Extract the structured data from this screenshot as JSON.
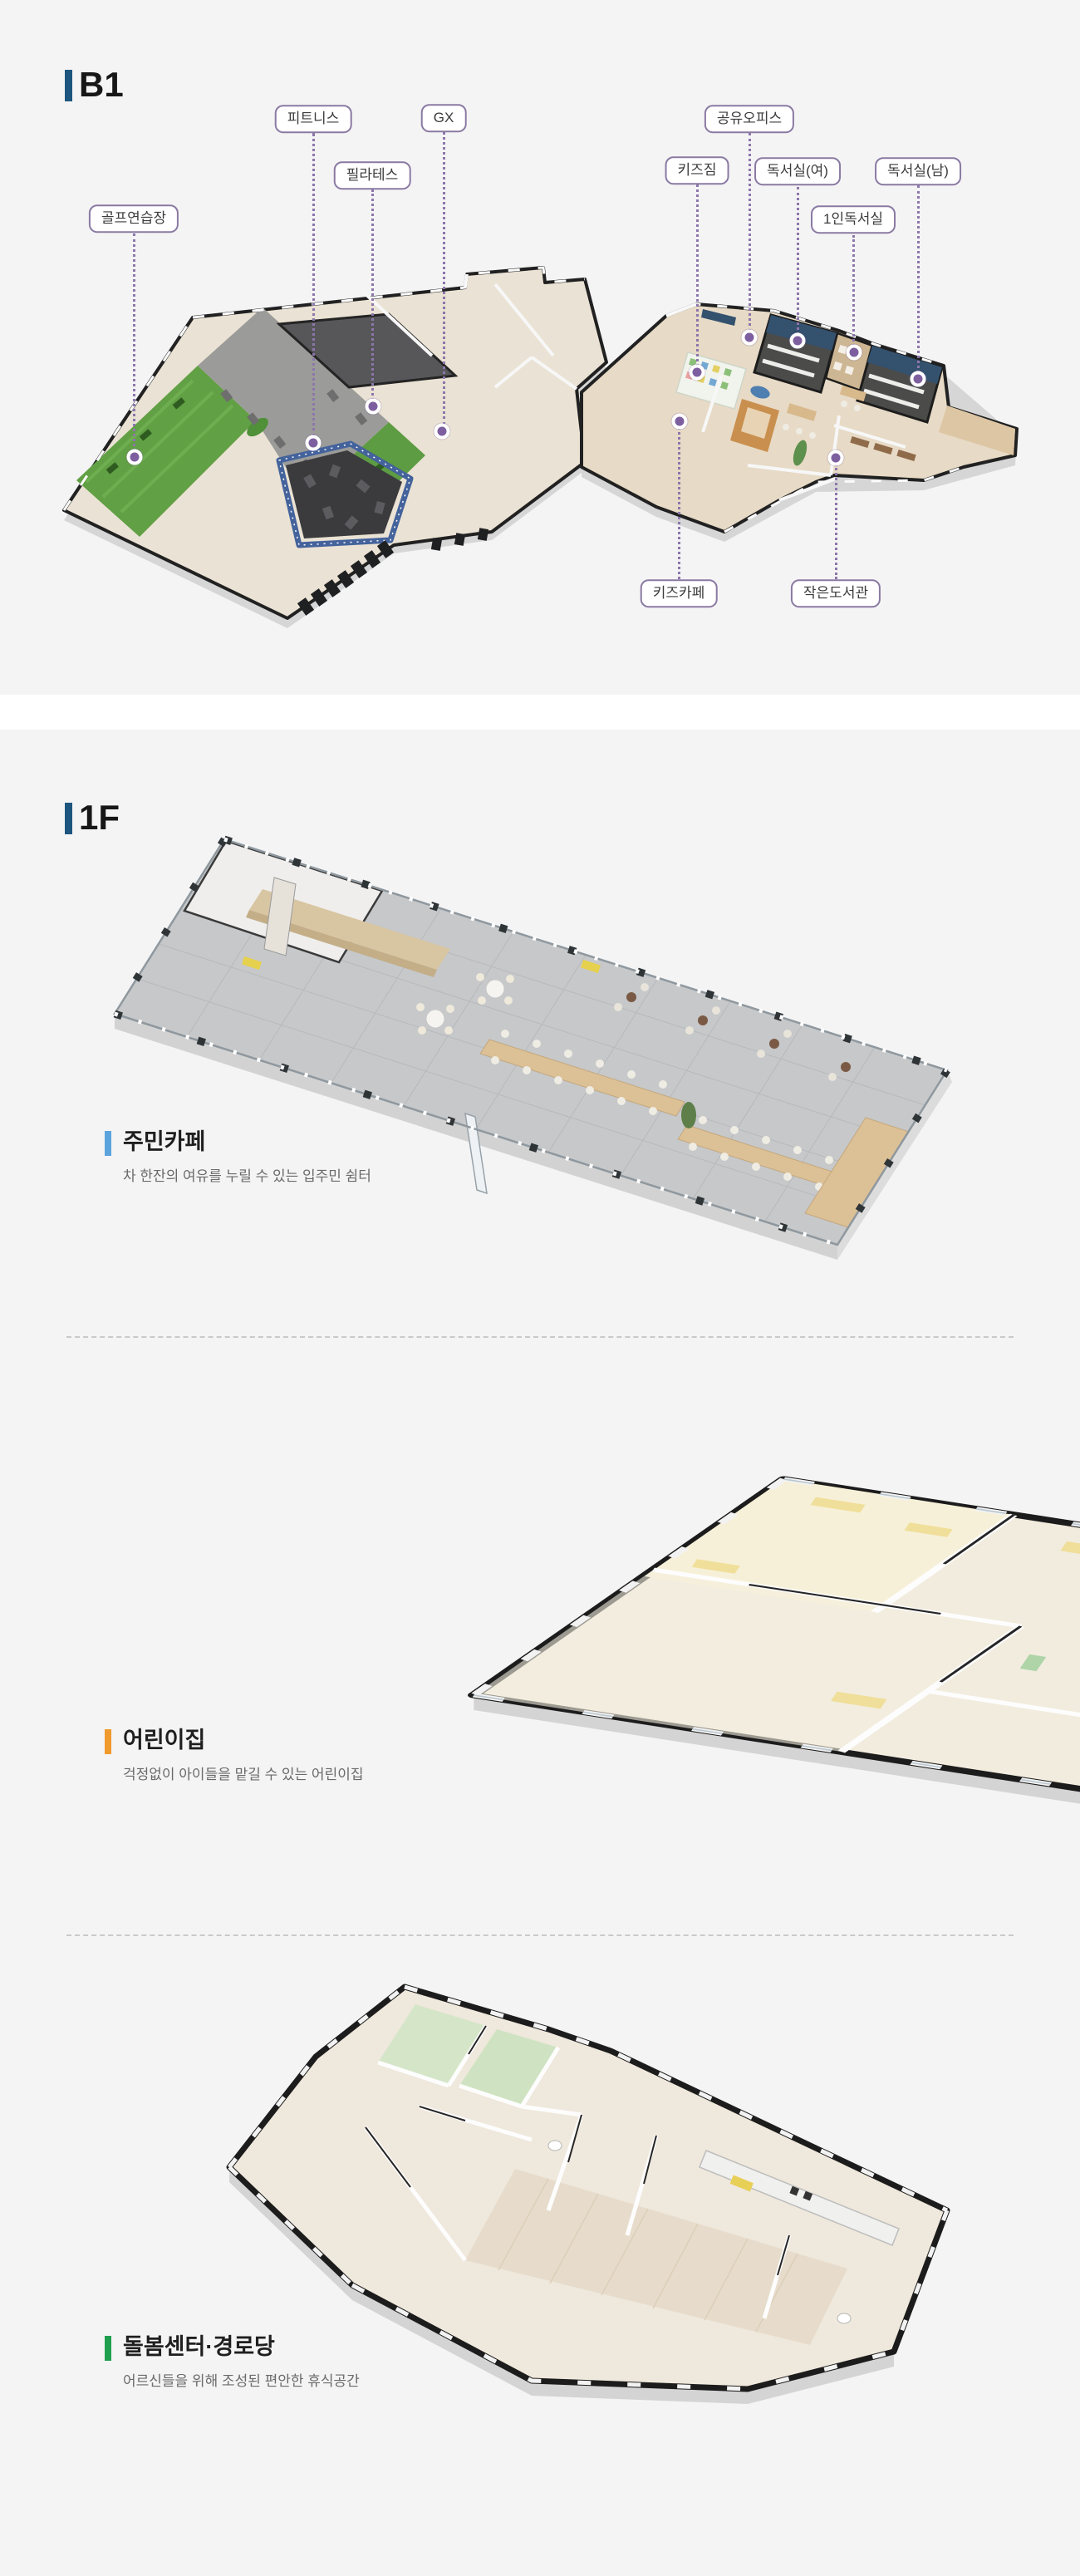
{
  "page": {
    "background": "#f4f4f5",
    "separator_band": "#ffffff",
    "label_border_color": "#8a7aa2",
    "leader_line_color": "#8d76ab",
    "header_accent": "#1c567e"
  },
  "b1": {
    "header": "B1",
    "labels": {
      "golf": "골프연습장",
      "fitness": "피트니스",
      "pilates": "필라테스",
      "gx": "GX",
      "office": "공유오피스",
      "kidsgym": "키즈짐",
      "reading_w": "독서실(여)",
      "reading_m": "독서실(남)",
      "reading_1": "1인독서실",
      "kidscafe": "키즈카페",
      "library": "작은도서관"
    }
  },
  "f1": {
    "header": "1F",
    "plans": [
      {
        "title": "주민카페",
        "subtitle": "차 한잔의 여유를 누릴 수 있는 입주민 쉼터",
        "accent": "#5ba3dc"
      },
      {
        "title": "어린이집",
        "subtitle": "걱정없이 아이들을 맡길 수 있는 어린이집",
        "accent": "#f09a2e"
      },
      {
        "title": "돌봄센터·경로당",
        "subtitle": "어르신들을 위해 조성된 편안한 휴식공간",
        "accent": "#1f9e4e"
      }
    ]
  }
}
